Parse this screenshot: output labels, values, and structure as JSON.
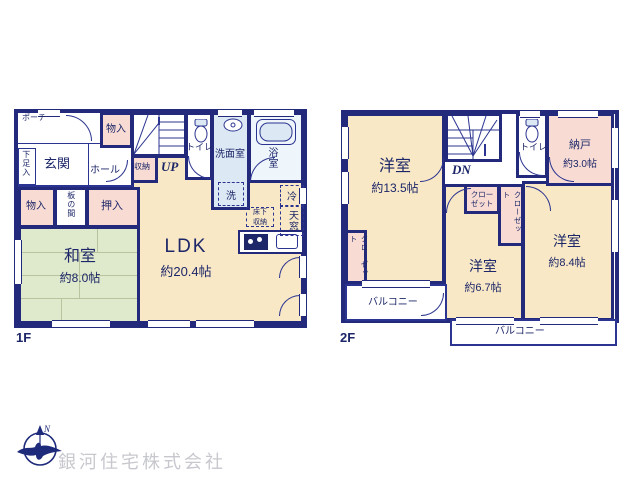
{
  "company_name": "銀河住宅株式会社",
  "compass": {
    "north": "N"
  },
  "colors": {
    "wall": "#232a7c",
    "room_cream": "#f8e8c6",
    "tatami_green": "#dfe9cb",
    "storage_pink": "#f8dcd4",
    "wet_area_blue": "#dce9f4"
  },
  "floor1": {
    "label": "1F",
    "porch": "ポーチ",
    "genkan": "玄関",
    "shoe_box": "下足入",
    "hall": "ホール",
    "storage_top": "物入",
    "stairs_storage": "収納",
    "stairs_label": "UP",
    "toilet": "トイレ",
    "washroom": "洗面室",
    "washer": "洗",
    "bathroom": "浴室",
    "storage_left": "物入",
    "itanoma": "板の間",
    "oshiire": "押入",
    "washitsu": {
      "name": "和室",
      "size": "約8.0帖"
    },
    "ldk": {
      "name": "LDK",
      "size": "約20.4帖"
    },
    "underfloor_storage": "床下収納",
    "fridge": "冷",
    "skylight": "天窓"
  },
  "floor2": {
    "label": "2F",
    "stairs_label": "DN",
    "toilet": "トイレ",
    "nando": {
      "name": "納戸",
      "size": "約3.0帖"
    },
    "closet_room1": "クローゼット",
    "closet_mid_a": "クローゼット",
    "closet_mid_b": "クローゼット",
    "room1": {
      "name": "洋室",
      "size": "約13.5帖"
    },
    "room2": {
      "name": "洋室",
      "size": "約6.7帖"
    },
    "room3": {
      "name": "洋室",
      "size": "約8.4帖"
    },
    "balcony_left": "バルコニー",
    "balcony_right": "バルコニー"
  }
}
